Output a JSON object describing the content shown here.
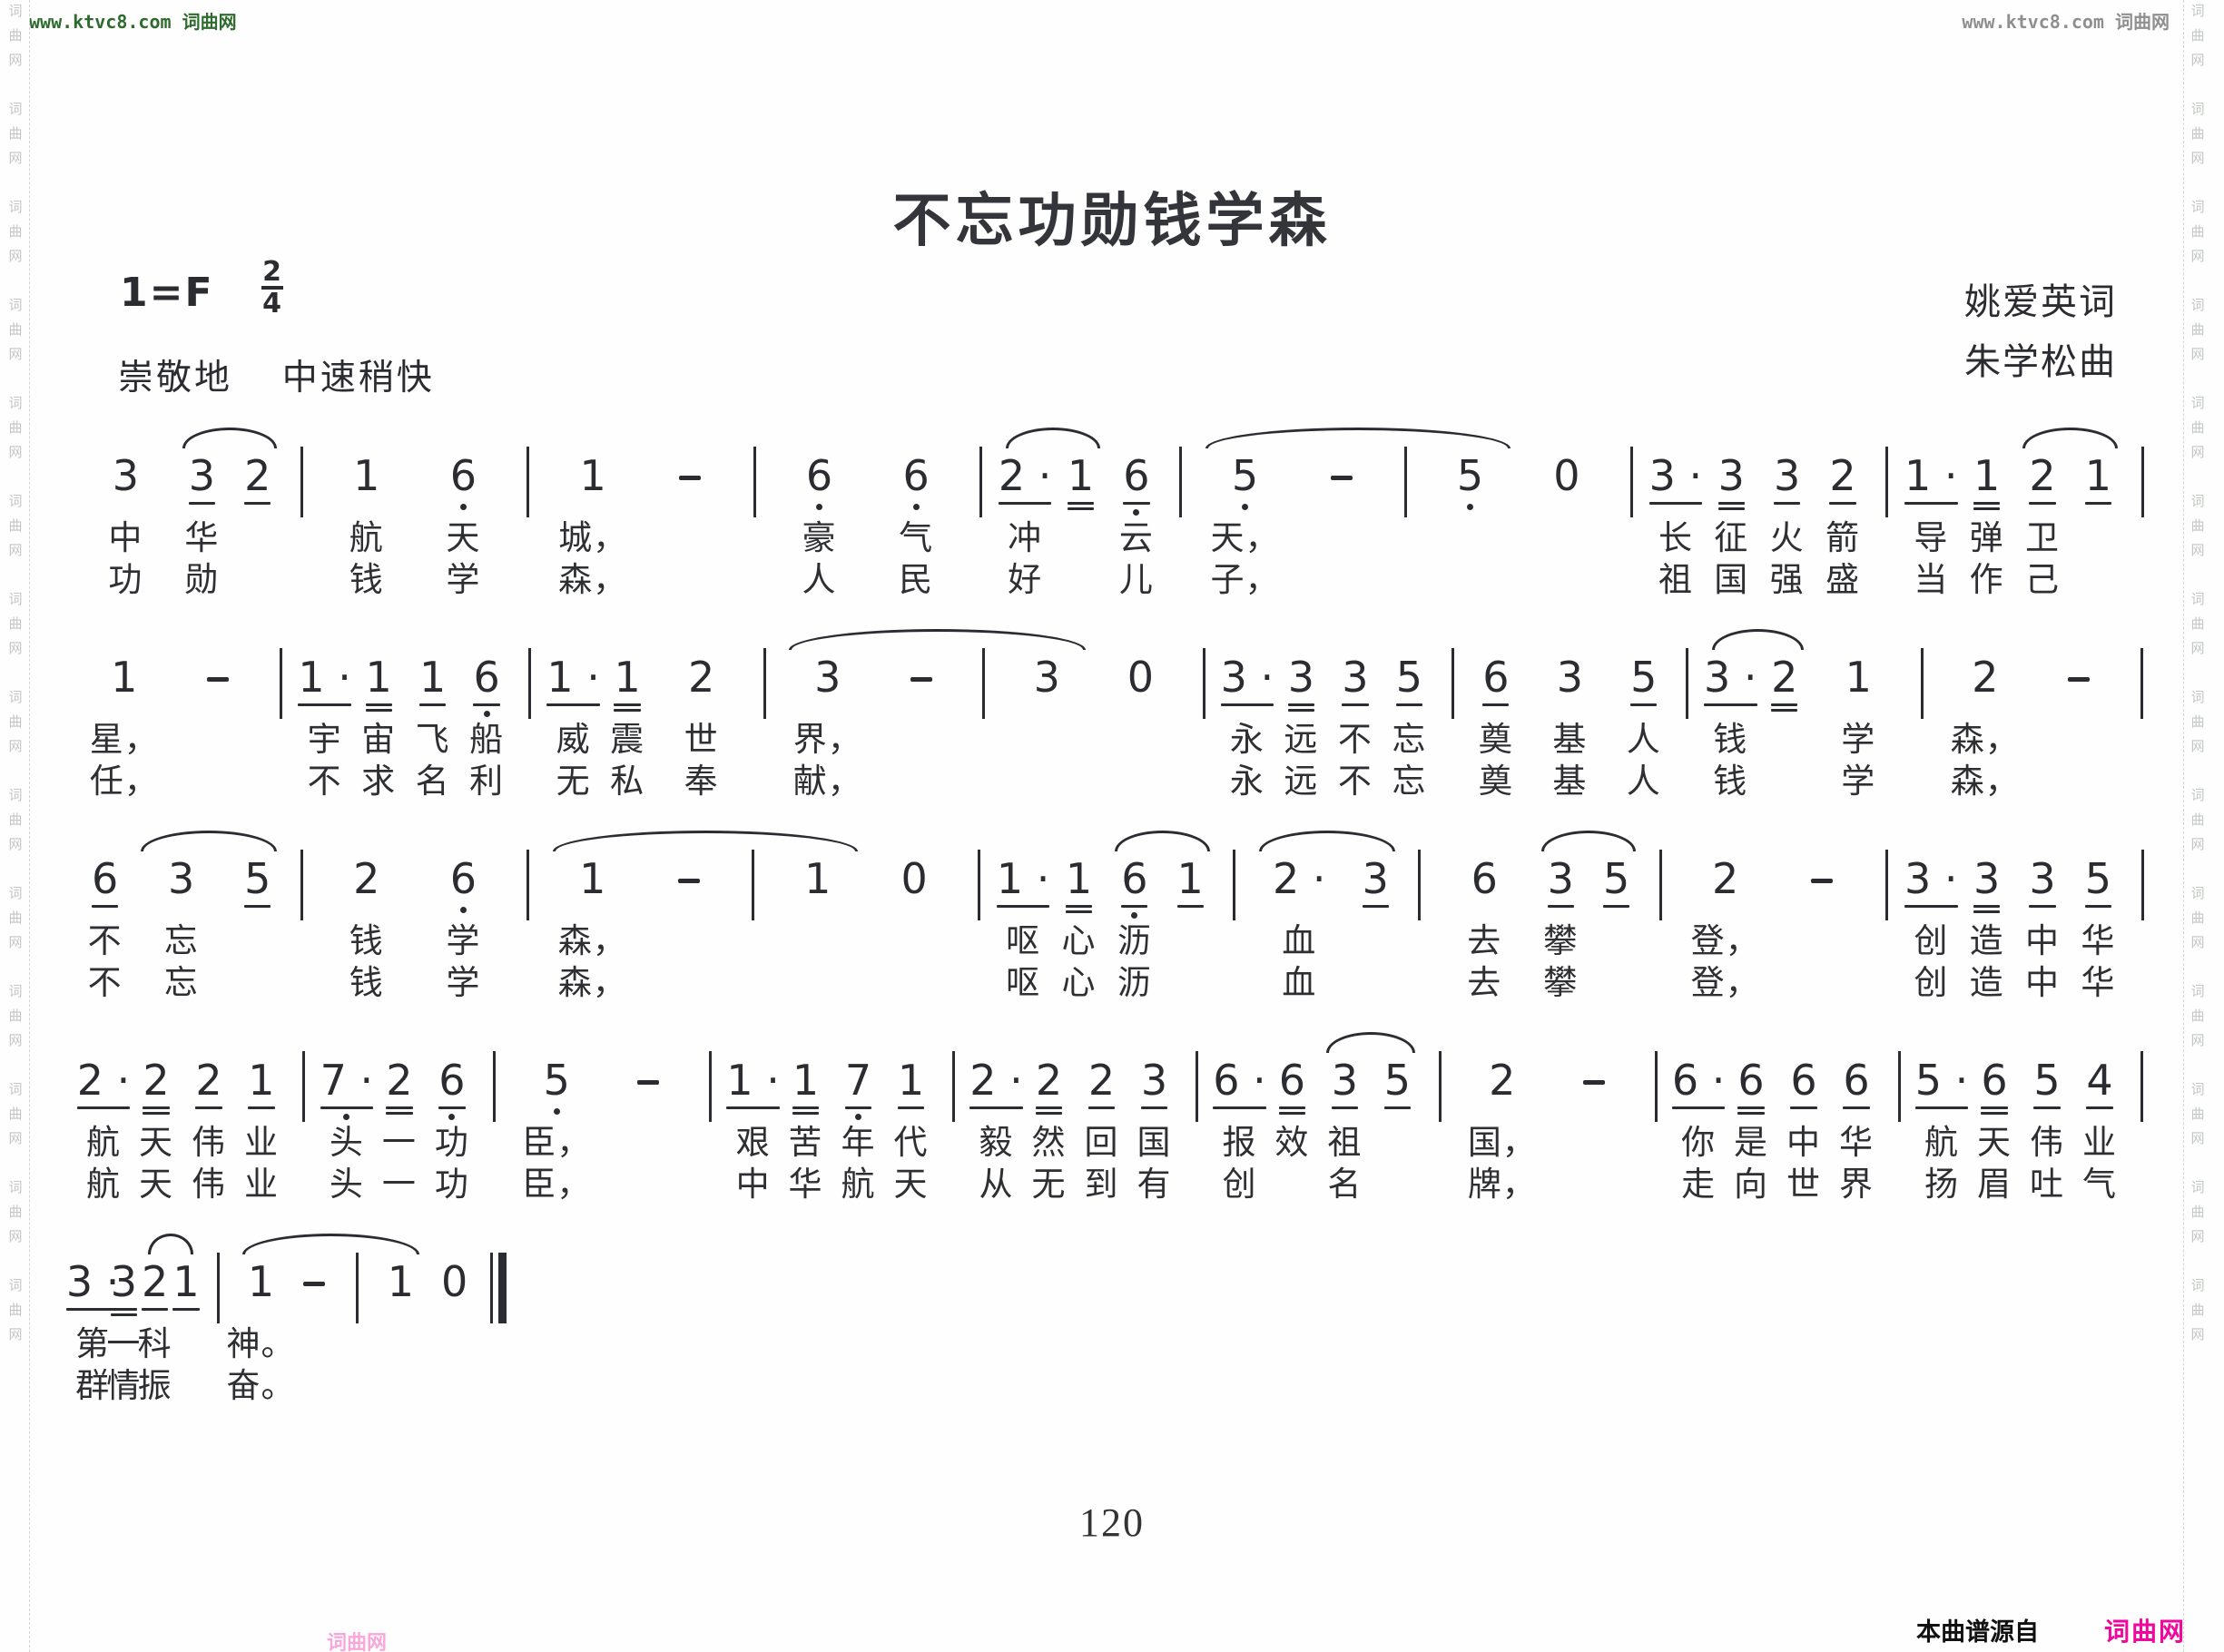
{
  "watermarks": {
    "top_left": "www.ktvc8.com 词曲网",
    "top_right": "www.ktvc8.com 词曲网",
    "side_vertical": "词曲网",
    "green": "#2e6b2e",
    "gray": "#8f8f8f"
  },
  "header": {
    "title": "不忘功勋钱学森",
    "key_signature": "1=F",
    "meter_numerator": "2",
    "meter_denominator": "4",
    "expression": "崇敬地",
    "tempo": "中速稍快",
    "lyricist": "姚爱英词",
    "composer": "朱学松曲"
  },
  "score": {
    "ink_color": "#2b2c31",
    "systems": [
      {
        "width": "100%",
        "tokens": [
          "3",
          {
            "a": [
              "3_",
              "2_"
            ]
          },
          "|",
          "1",
          "6,",
          "|",
          "1",
          "-",
          "|",
          "6,",
          "6,",
          "|",
          {
            "a": [
              "2._",
              "1="
            ]
          },
          "6,_",
          "|",
          {
            "a": [
              "5,",
              "-",
              "|",
              "5,"
            ]
          },
          "0",
          "|",
          "3._",
          "3=",
          "3_",
          "2_",
          "|",
          "1._",
          "1=",
          {
            "a": [
              "2_",
              "1_"
            ]
          },
          "|"
        ],
        "v1": [
          "中",
          "华",
          "",
          "",
          "航",
          "天",
          "",
          "城，",
          "",
          "",
          "豪",
          "气",
          "",
          "冲",
          "",
          "云",
          "",
          "天，",
          "",
          "",
          "",
          "",
          "",
          "长",
          "征",
          "火",
          "箭",
          "",
          "导",
          "弹",
          "卫",
          "",
          ""
        ],
        "v2": [
          "功",
          "勋",
          "",
          "",
          "钱",
          "学",
          "",
          "森，",
          "",
          "",
          "人",
          "民",
          "",
          "好",
          "",
          "儿",
          "",
          "子，",
          "",
          "",
          "",
          "",
          "",
          "祖",
          "国",
          "强",
          "盛",
          "",
          "当",
          "作",
          "己",
          "",
          ""
        ]
      },
      {
        "width": "100%",
        "tokens": [
          "1",
          "-",
          "|",
          "1._",
          "1=",
          "1_",
          "6,_",
          "|",
          "1._",
          "1=",
          "2",
          "|",
          {
            "a": [
              "3",
              "-",
              "|",
              "3"
            ]
          },
          "0",
          "|",
          "3._",
          "3=",
          "3_",
          "5_",
          "|",
          "6_",
          "3",
          "5_",
          "|",
          {
            "a": [
              "3._",
              "2="
            ]
          },
          "1",
          "|",
          "2",
          "-",
          "|"
        ],
        "v1": [
          "星，",
          "",
          "",
          "宇",
          "宙",
          "飞",
          "船",
          "",
          "威",
          "震",
          "世",
          "",
          "界，",
          "",
          "",
          "",
          "",
          "",
          "永",
          "远",
          "不",
          "忘",
          "",
          "奠",
          "基",
          "人",
          "",
          "钱",
          "",
          "学",
          "",
          "森，",
          "",
          ""
        ],
        "v2": [
          "任，",
          "",
          "",
          "不",
          "求",
          "名",
          "利",
          "",
          "无",
          "私",
          "奉",
          "",
          "献，",
          "",
          "",
          "",
          "",
          "",
          "永",
          "远",
          "不",
          "忘",
          "",
          "奠",
          "基",
          "人",
          "",
          "钱",
          "",
          "学",
          "",
          "森，",
          "",
          ""
        ]
      },
      {
        "width": "100%",
        "tokens": [
          "6_",
          {
            "a": [
              "3",
              "5_"
            ]
          },
          "|",
          "2",
          "6,",
          "|",
          {
            "a": [
              "1",
              "-",
              "|",
              "1"
            ]
          },
          "0",
          "|",
          "1._",
          "1=",
          {
            "a": [
              "6,_",
              "1_"
            ]
          },
          "|",
          {
            "a": [
              "2.",
              "3_"
            ]
          },
          "|",
          "6",
          {
            "a": [
              "3_",
              "5_"
            ]
          },
          "|",
          "2",
          "-",
          "|",
          "3._",
          "3=",
          "3_",
          "5_",
          "|"
        ],
        "v1": [
          "不",
          "忘",
          "",
          "",
          "钱",
          "学",
          "",
          "森，",
          "",
          "",
          "",
          "",
          "",
          "呕",
          "心",
          "沥",
          "",
          "",
          "血",
          "",
          "",
          "去",
          "攀",
          "",
          "",
          "登，",
          "",
          "",
          "创",
          "造",
          "中",
          "华",
          ""
        ],
        "v2": [
          "不",
          "忘",
          "",
          "",
          "钱",
          "学",
          "",
          "森，",
          "",
          "",
          "",
          "",
          "",
          "呕",
          "心",
          "沥",
          "",
          "",
          "血",
          "",
          "",
          "去",
          "攀",
          "",
          "",
          "登，",
          "",
          "",
          "创",
          "造",
          "中",
          "华",
          ""
        ]
      },
      {
        "width": "100%",
        "tokens": [
          "2._",
          "2=",
          "2_",
          "1_",
          "|",
          "7.,_",
          "2=",
          "6,_",
          "|",
          "5,",
          "-",
          "|",
          "1._",
          "1=",
          "7,_",
          "1_",
          "|",
          "2._",
          "2=",
          "2_",
          "3_",
          "|",
          "6._",
          "6=",
          {
            "a": [
              "3_",
              "5_"
            ]
          },
          "|",
          "2",
          "-",
          "|",
          "6._",
          "6=",
          "6_",
          "6_",
          "|",
          "5._",
          "6=",
          "5_",
          "4_",
          "|"
        ],
        "v1": [
          "航",
          "天",
          "伟",
          "业",
          "",
          "头",
          "一",
          "功",
          "",
          "臣，",
          "",
          "",
          "艰",
          "苦",
          "年",
          "代",
          "",
          "毅",
          "然",
          "回",
          "国",
          "",
          "报",
          "效",
          "祖",
          "",
          "",
          "国，",
          "",
          "",
          "你",
          "是",
          "中",
          "华",
          "",
          "航",
          "天",
          "伟",
          "业",
          ""
        ],
        "v2": [
          "航",
          "天",
          "伟",
          "业",
          "",
          "头",
          "一",
          "功",
          "",
          "臣，",
          "",
          "",
          "中",
          "华",
          "航",
          "天",
          "",
          "从",
          "无",
          "到",
          "有",
          "",
          "创",
          "",
          "名",
          "",
          "",
          "牌，",
          "",
          "",
          "走",
          "向",
          "世",
          "界",
          "",
          "扬",
          "眉",
          "吐",
          "气",
          ""
        ]
      },
      {
        "width": "21%",
        "tokens": [
          "3._",
          "3=",
          {
            "a": [
              "2_",
              "1_"
            ]
          },
          "|",
          {
            "a": [
              "1",
              "-",
              "|",
              "1"
            ]
          },
          "0",
          "||"
        ],
        "v1": [
          "第",
          "一",
          "科",
          "",
          "",
          "神。",
          "",
          "",
          "",
          "",
          ""
        ],
        "v2": [
          "群",
          "情",
          "振",
          "",
          "",
          "奋。",
          "",
          "",
          "",
          "",
          ""
        ]
      }
    ]
  },
  "footer": {
    "page_number": "120",
    "source_label": "本曲谱源自",
    "source_logo": "词曲网",
    "logo_color": "#f0079d"
  }
}
